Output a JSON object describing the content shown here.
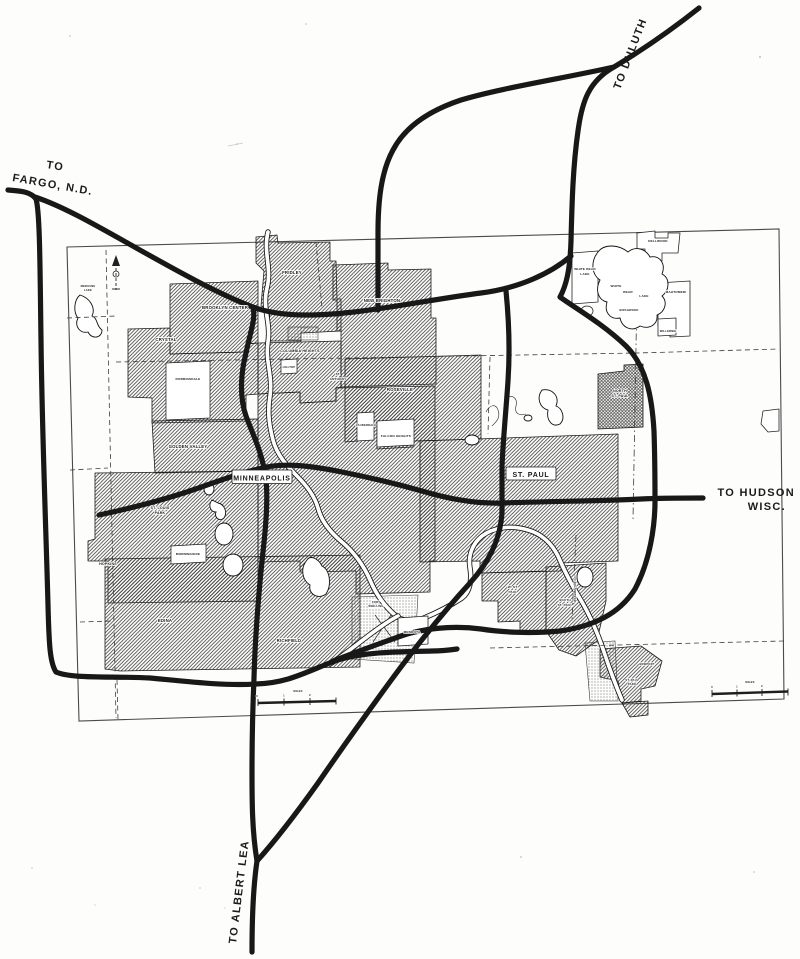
{
  "map_title": "Twin Cities metropolitan area scanned highway map",
  "routes": {
    "fargo_line1": "TO",
    "fargo_line2": "FARGO, N.D.",
    "duluth": "TO DULUTH",
    "hudson_line1": "TO HUDSON",
    "hudson_line2": "WISC.",
    "albert_lea": "TO ALBERT LEA"
  },
  "cities": {
    "minneapolis": "MINNEAPOLIS",
    "st_paul": "ST.  PAUL",
    "brooklyn_center": "BROOKLYN CENTER",
    "fridley": "FRIDLEY",
    "new_brighton": "NEW BRIGHTON",
    "columbia_heights": "COLUMBIA  HEIGHTS",
    "hilltop": "HILLTOP",
    "st_anthony_1": "ST.",
    "st_anthony_2": "ANTHONY",
    "crystal": "CRYSTAL",
    "robbinsdale": "ROBBINSDALE",
    "medicine_lake_1": "MEDICINE",
    "medicine_lake_2": "LAKE",
    "golden_valley": "GOLDEN  VALLEY",
    "st_louis_park_1": "ST. LOUIS",
    "st_louis_park_2": "PARK",
    "morningside": "MORNINGSIDE",
    "hopkins": "HOPKINS",
    "edina": "EDINA",
    "richfield": "RICHFIELD",
    "roseville": "ROSEVILLE",
    "lauderdale": "LAUDERDALE",
    "falcon_heights": "FALCON HEIGHTS",
    "north_st_paul_1": "NORTH",
    "north_st_paul_2": "ST. PAUL",
    "white_bear_city_1": "WHITE BEAR",
    "white_bear_city_2": "LAKE",
    "dellwood": "DELLWOOD",
    "mahtomedi": "MAHTOMEDI",
    "willernie": "WILLERNIE",
    "birchwood": "BIRCHWOOD",
    "west_st_paul_1": "W. ST.",
    "west_st_paul_2": "PAUL",
    "south_st_paul_1": "SOUTH",
    "south_st_paul_2": "ST. PAUL",
    "mendota": "MENDOTA",
    "newport": "NEWPORT",
    "st_paul_park_1": "ST. PAUL",
    "st_paul_park_2": "PARK",
    "fort_snelling_1": "FORT",
    "fort_snelling_2": "SNELLING"
  },
  "lakes": {
    "white_bear_1": "WHITE",
    "white_bear_2": "BEAR",
    "white_bear_3": "LAKE"
  },
  "county_line": {
    "washington": "WASHINGTON CO."
  },
  "scale": {
    "n0": "0",
    "n1": "1",
    "n2": "2",
    "miles": "MILES"
  }
}
